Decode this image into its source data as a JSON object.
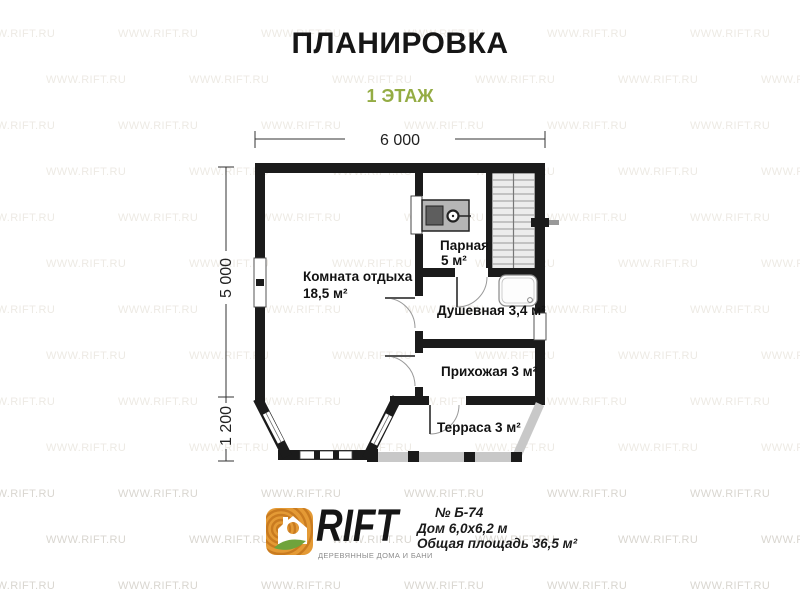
{
  "header": {
    "title": "ПЛАНИРОВКА",
    "subtitle": "1 ЭТАЖ"
  },
  "watermark": {
    "text": "WWW.RIFT.RU"
  },
  "plan": {
    "dim_width": "6 000",
    "dim_height_main": "5 000",
    "dim_height_bay": "1 200",
    "rooms": {
      "lounge": {
        "name": "Комната отдыха",
        "area": "18,5 м²"
      },
      "sauna": {
        "name": "Парная",
        "area": "5 м²"
      },
      "shower": {
        "label": "Душевная 3,4 м²"
      },
      "hallway": {
        "label": "Прихожая 3 м²"
      },
      "terrace": {
        "label": "Терраса 3 м²"
      }
    }
  },
  "footer": {
    "brand": "RIFT",
    "tagline": "ДЕРЕВЯННЫЕ ДОМА И БАНИ",
    "project_no": "№ Б-74",
    "house_size": "Дом 6,0х6,2 м",
    "total_area": "Общая площадь 36,5 м²"
  },
  "colors": {
    "wall": "#1b1b1b",
    "accent_green": "#94ac44",
    "terrace_rail": "#c8c8c8",
    "watermark_light": "#edeae4",
    "watermark_dark": "#d9d6d0"
  }
}
